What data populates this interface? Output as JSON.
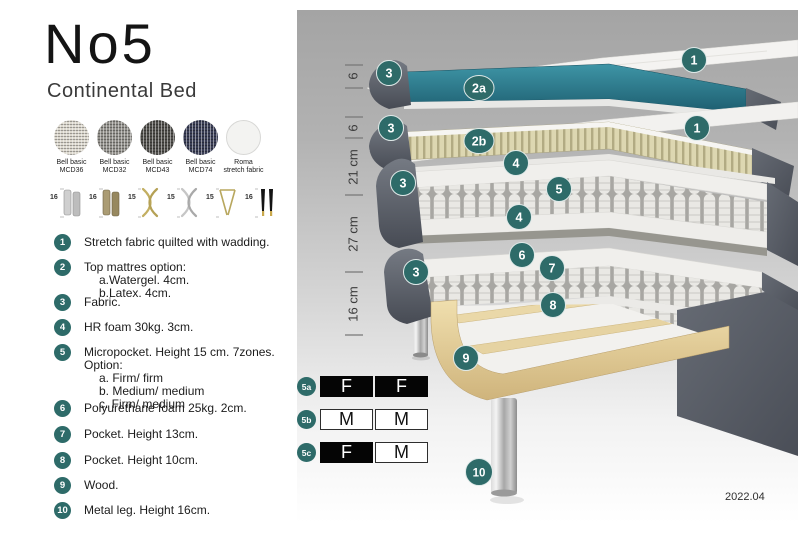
{
  "header": {
    "title": "No5",
    "subtitle": "Continental Bed"
  },
  "fabrics": [
    {
      "name": "Bell basic",
      "code": "MCD36",
      "color": "#dcd8ce"
    },
    {
      "name": "Bell basic",
      "code": "MCD32",
      "color": "#92908b"
    },
    {
      "name": "Bell basic",
      "code": "MCD43",
      "color": "#504f4b"
    },
    {
      "name": "Bell basic",
      "code": "MCD74",
      "color": "#3a3e56"
    },
    {
      "name": "Roma",
      "code": "stretch fabric",
      "color": "#f3f3f1"
    }
  ],
  "legs": [
    {
      "height": "16",
      "type": "cylinder-silver"
    },
    {
      "height": "16",
      "type": "cylinder-bronze"
    },
    {
      "height": "15",
      "type": "cross-gold"
    },
    {
      "height": "15",
      "type": "cross-silver"
    },
    {
      "height": "15",
      "type": "hairpin-gold"
    },
    {
      "height": "16",
      "type": "tapered-black-gold"
    }
  ],
  "legend": [
    {
      "num": "1",
      "text": "Stretch fabric quilted with wadding."
    },
    {
      "num": "2",
      "text": "Top mattres option:",
      "sub": [
        "a.Watergel. 4cm.",
        "b.Latex. 4cm."
      ]
    },
    {
      "num": "3",
      "text": "Fabric."
    },
    {
      "num": "4",
      "text": "HR foam 30kg. 3cm."
    },
    {
      "num": "5",
      "text": "Micropocket. Height 15 cm. 7zones. Option:",
      "sub": [
        "a. Firm/ firm",
        "b. Medium/ medium",
        "c. Firm/ medium"
      ]
    },
    {
      "num": "6",
      "text": "Polyurethane foam 25kg. 2cm."
    },
    {
      "num": "7",
      "text": "Pocket. Height 13cm."
    },
    {
      "num": "8",
      "text": "Pocket. Height 10cm."
    },
    {
      "num": "9",
      "text": "Wood."
    },
    {
      "num": "10",
      "text": "Metal leg. Height 16cm."
    }
  ],
  "diagram": {
    "dimensions": [
      "6",
      "6",
      "21 cm",
      "27 cm",
      "16 cm"
    ],
    "callouts": [
      "1",
      "2a",
      "3",
      "1",
      "2b",
      "3",
      "4",
      "5",
      "4",
      "3",
      "6",
      "7",
      "8",
      "3",
      "9",
      "10"
    ],
    "colors": {
      "badge": "#2e6b69",
      "watergel_layer": "#2a7c8e",
      "latex_layer": "#d9d3ac",
      "wood": "#e3cf9b",
      "dark_fabric": "#5b6069",
      "chrome_leg": "#c9c9c9"
    }
  },
  "firmness_table": {
    "rows": [
      {
        "label": "5a",
        "cells": [
          {
            "value": "F",
            "variant": "dark"
          },
          {
            "value": "F",
            "variant": "dark"
          }
        ]
      },
      {
        "label": "5b",
        "cells": [
          {
            "value": "M",
            "variant": "light"
          },
          {
            "value": "M",
            "variant": "light"
          }
        ]
      },
      {
        "label": "5c",
        "cells": [
          {
            "value": "F",
            "variant": "dark"
          },
          {
            "value": "M",
            "variant": "light"
          }
        ]
      }
    ]
  },
  "version": "2022.04"
}
